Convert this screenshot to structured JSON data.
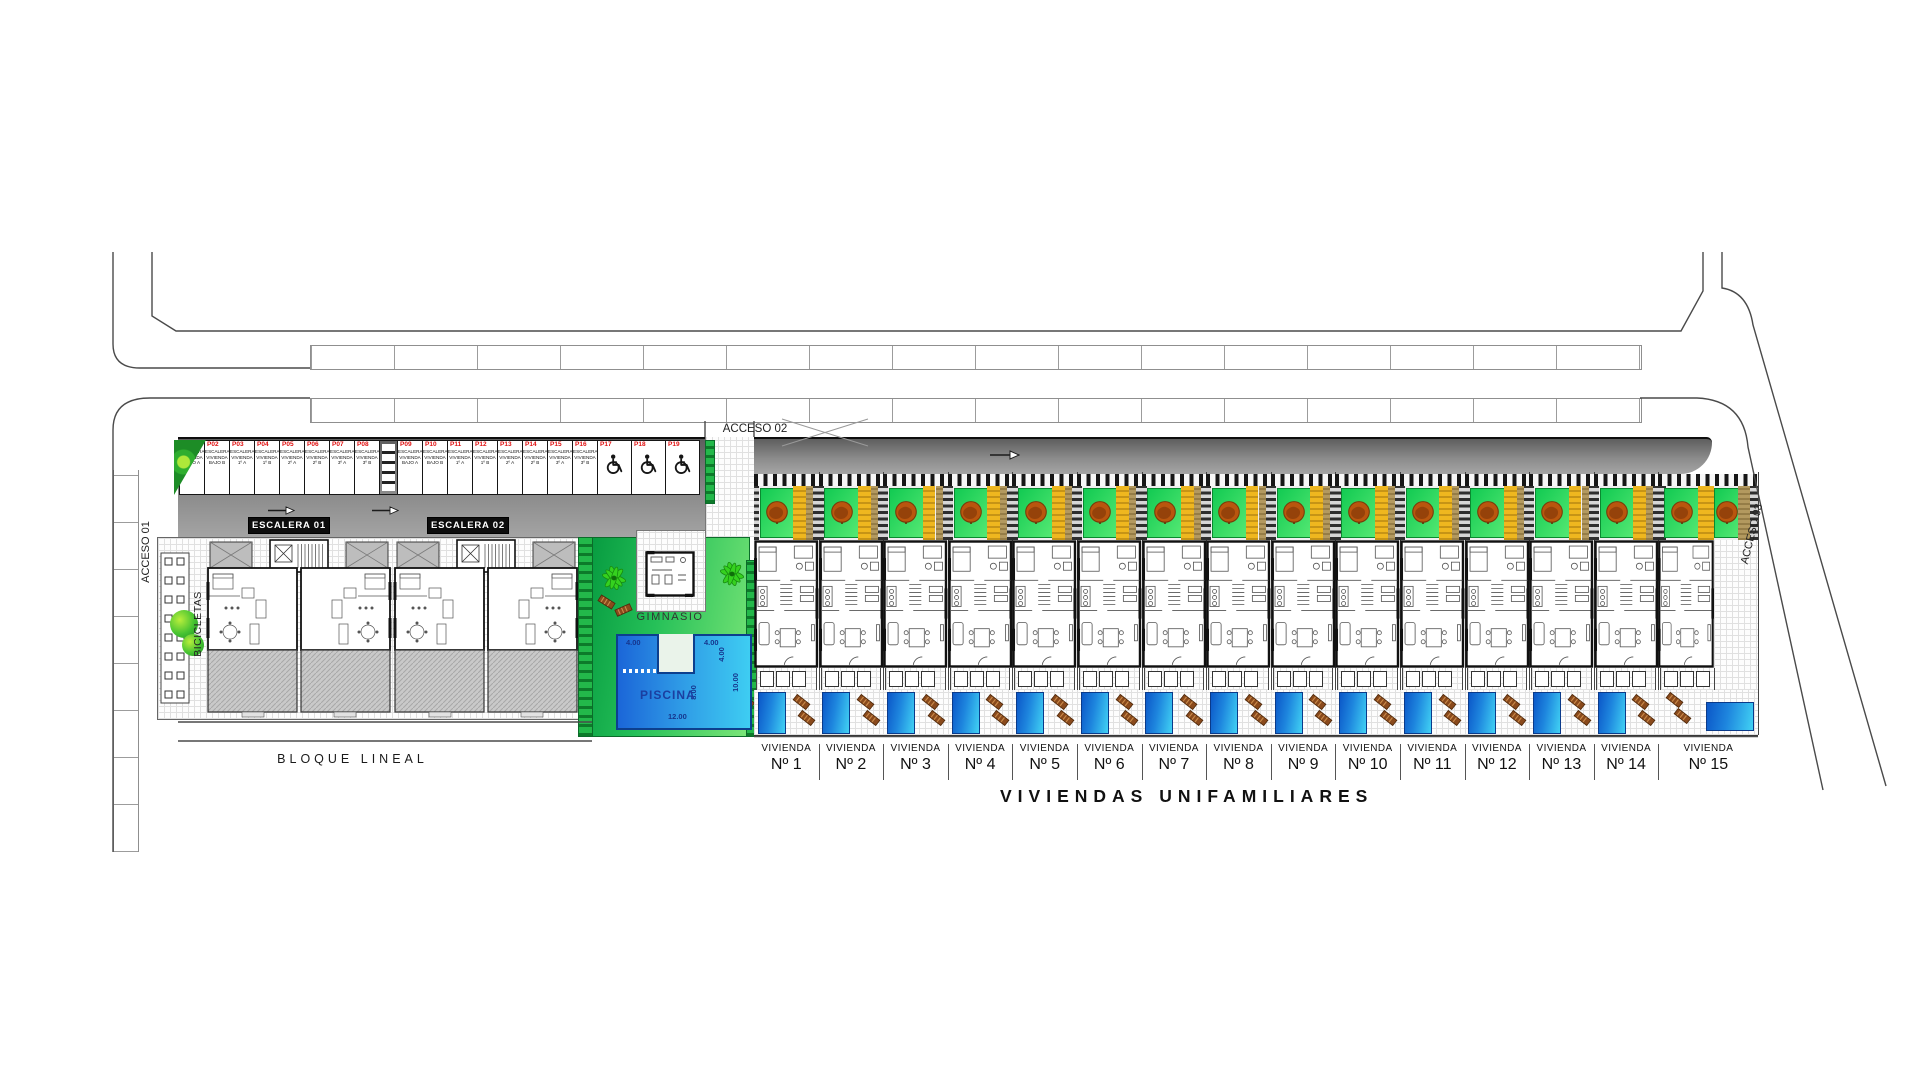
{
  "plan": {
    "title": "VIVIENDAS UNIFAMILIARES",
    "block": {
      "label": "BLOQUE LINEAL",
      "bicycles": "BICICLETAS",
      "stairs": [
        "ESCALERA 01",
        "ESCALERA 02"
      ]
    },
    "access": {
      "a01": "ACCESO 01",
      "a02": "ACCESO 02",
      "a03": "ACCESO 03"
    },
    "amenities": {
      "gym_label": "GIMNASIO",
      "pool": {
        "label": "PISCINA",
        "dim_top_left": "4.00",
        "dim_top_right": "4.00",
        "dim_notch": "4.00",
        "dim_right": "10.00",
        "dim_inner": "8.00",
        "dim_bottom": "12.00"
      }
    },
    "parking": {
      "stalls": [
        {
          "code": "P01",
          "l1": "ESCALERA 1",
          "l2": "VIVIENDA",
          "l3": "BAJO A"
        },
        {
          "code": "P02",
          "l1": "ESCALERA 1",
          "l2": "VIVIENDA",
          "l3": "BAJO B"
        },
        {
          "code": "P03",
          "l1": "ESCALERA 1",
          "l2": "VIVIENDA",
          "l3": "1º A"
        },
        {
          "code": "P04",
          "l1": "ESCALERA 1",
          "l2": "VIVIENDA",
          "l3": "1º B"
        },
        {
          "code": "P05",
          "l1": "ESCALERA 1",
          "l2": "VIVIENDA",
          "l3": "2º A"
        },
        {
          "code": "P06",
          "l1": "ESCALERA 1",
          "l2": "VIVIENDA",
          "l3": "2º B"
        },
        {
          "code": "P07",
          "l1": "ESCALERA 1",
          "l2": "VIVIENDA",
          "l3": "3º A"
        },
        {
          "code": "P08",
          "l1": "ESCALERA 1",
          "l2": "VIVIENDA",
          "l3": "3º B"
        },
        {
          "code": "P09",
          "l1": "ESCALERA 2",
          "l2": "VIVIENDA",
          "l3": "BAJO A"
        },
        {
          "code": "P10",
          "l1": "ESCALERA 2",
          "l2": "VIVIENDA",
          "l3": "BAJO B"
        },
        {
          "code": "P11",
          "l1": "ESCALERA 2",
          "l2": "VIVIENDA",
          "l3": "1º A"
        },
        {
          "code": "P12",
          "l1": "ESCALERA 2",
          "l2": "VIVIENDA",
          "l3": "1º B"
        },
        {
          "code": "P13",
          "l1": "ESCALERA 2",
          "l2": "VIVIENDA",
          "l3": "2º A"
        },
        {
          "code": "P14",
          "l1": "ESCALERA 2",
          "l2": "VIVIENDA",
          "l3": "2º B"
        },
        {
          "code": "P15",
          "l1": "ESCALERA 2",
          "l2": "VIVIENDA",
          "l3": "3º A"
        },
        {
          "code": "P16",
          "l1": "ESCALERA 2",
          "l2": "VIVIENDA",
          "l3": "3º B"
        },
        {
          "code": "P17",
          "icon": "wheelchair-icon",
          "accessible": true
        },
        {
          "code": "P18",
          "icon": "wheelchair-icon",
          "accessible": true
        },
        {
          "code": "P19",
          "icon": "wheelchair-icon",
          "accessible": true
        }
      ]
    },
    "villas": {
      "unit_label": "VIVIENDA",
      "numbers": [
        "Nº 1",
        "Nº 2",
        "Nº 3",
        "Nº 4",
        "Nº 5",
        "Nº 6",
        "Nº 7",
        "Nº 8",
        "Nº 9",
        "Nº 10",
        "Nº 11",
        "Nº 12",
        "Nº 13",
        "Nº 14",
        "Nº 15"
      ]
    }
  }
}
